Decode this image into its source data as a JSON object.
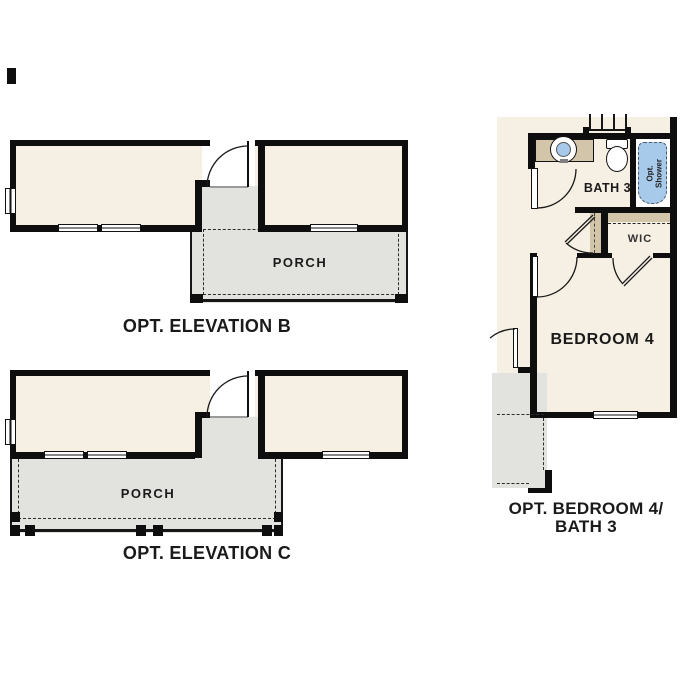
{
  "colors": {
    "interior_cream": "#f6efe3",
    "porch_gray": "#e2e2df",
    "wall_black": "#0e0e0e",
    "fixture_tan": "#d2c5a9",
    "fixture_blue": "#a7c9ea",
    "page_white": "#ffffff",
    "line_dark": "#1a1a1a"
  },
  "plans": {
    "elevation_b": {
      "caption": "OPT. ELEVATION B",
      "porch_label": "PORCH"
    },
    "elevation_c": {
      "caption": "OPT. ELEVATION C",
      "porch_label": "PORCH"
    },
    "bedroom4_bath3": {
      "caption_line1": "OPT. BEDROOM 4/",
      "caption_line2": "BATH 3",
      "rooms": {
        "bath": "BATH 3",
        "wic": "WIC",
        "bedroom": "BEDROOM 4"
      },
      "shower_label_line1": "Opt.",
      "shower_label_line2": "Shower"
    }
  }
}
